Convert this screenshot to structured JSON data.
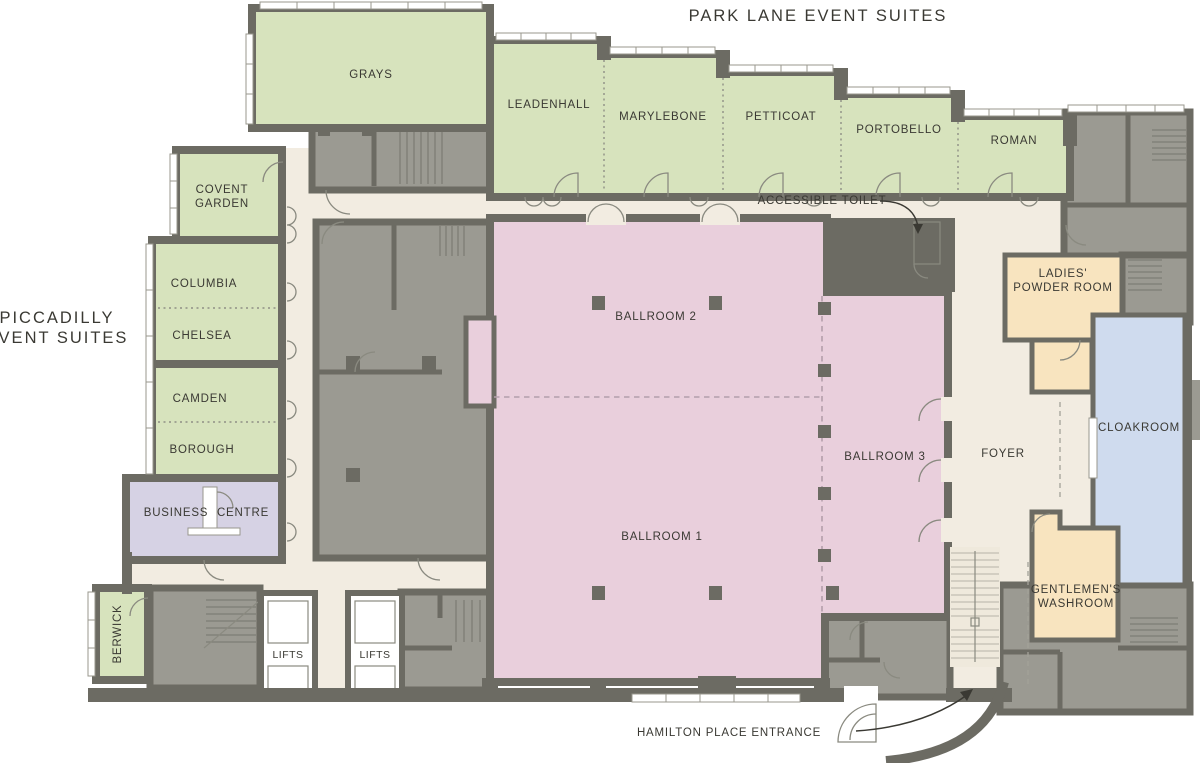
{
  "titles": {
    "park_lane": "PARK LANE EVENT SUITES",
    "piccadilly": [
      "PICCADILLY",
      "EVENT SUITES"
    ]
  },
  "rooms": {
    "park_lane_suites": {
      "grays": "GRAYS",
      "leadenhall": "LEADENHALL",
      "marylebone": "MARYLEBONE",
      "petticoat": "PETTICOAT",
      "portobello": "PORTOBELLO",
      "roman": "ROMAN"
    },
    "piccadilly_suites": {
      "covent_garden": [
        "COVENT",
        "GARDEN"
      ],
      "columbia": "COLUMBIA",
      "chelsea": "CHELSEA",
      "camden": "CAMDEN",
      "borough": "BOROUGH",
      "berwick": "BERWICK"
    },
    "ballrooms": {
      "ballroom_1": "BALLROOM 1",
      "ballroom_2": "BALLROOM 2",
      "ballroom_3": "BALLROOM 3"
    },
    "facilities": {
      "business_centre": [
        "BUSINESS",
        "CENTRE"
      ],
      "foyer": "FOYER",
      "cloakroom": "CLOAKROOM",
      "ladies_powder_room": [
        "LADIES'",
        "POWDER ROOM"
      ],
      "gentlemens_washroom": [
        "GENTLEMEN'S",
        "WASHROOM"
      ],
      "accessible_toilet": "ACCESSIBLE TOILET",
      "lifts_a": "LIFTS",
      "lifts_b": "LIFTS"
    }
  },
  "annotations": {
    "hamilton_entrance": "HAMILTON PLACE ENTRANCE"
  },
  "colors": {
    "wall": "#6c6b63",
    "service_gray": "#9b9a92",
    "event_suite_green": "#d7e3bd",
    "ballroom_pink": "#e9cfdc",
    "corridor_cream": "#f2ece1",
    "stair_cream": "#efe9dc",
    "business_lavender": "#d6d2e4",
    "washroom_tan": "#f8e4bf",
    "cloakroom_blue": "#cfdbee",
    "text": "#3a3933"
  }
}
